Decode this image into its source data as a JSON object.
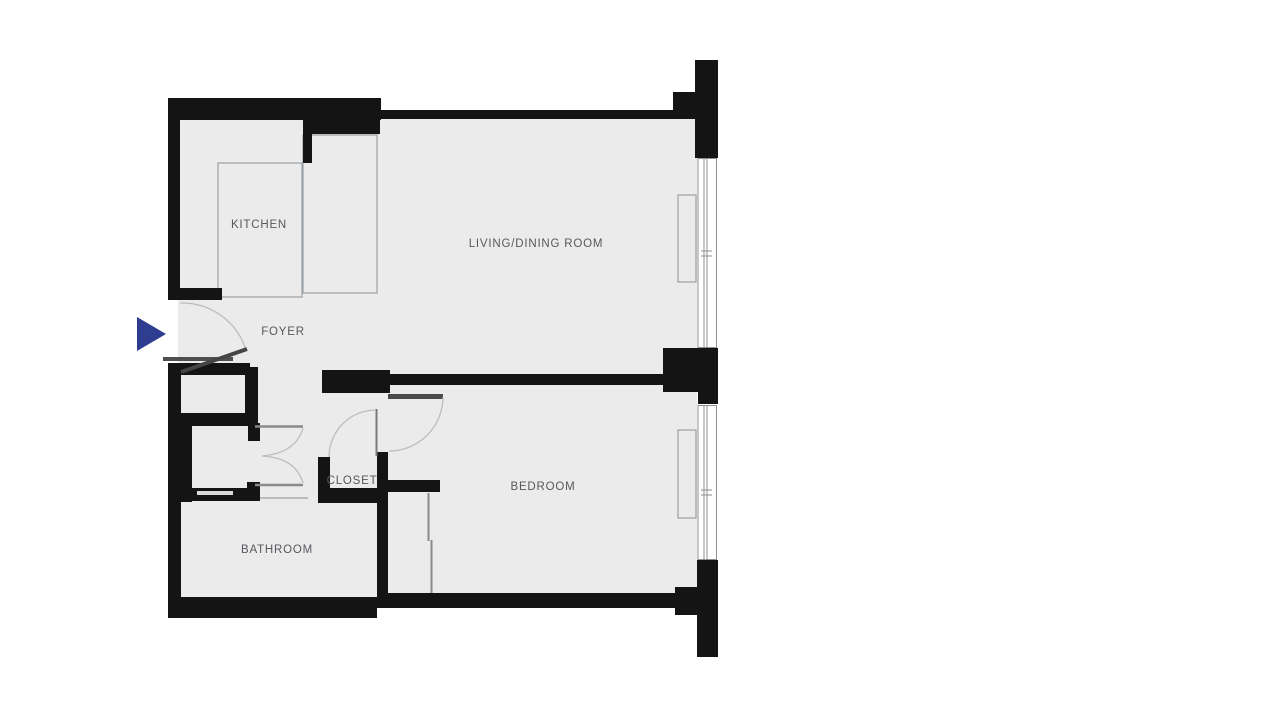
{
  "plan": {
    "title": "One-bedroom apartment floor plan",
    "rooms": [
      {
        "id": "kitchen",
        "label": "KITCHEN"
      },
      {
        "id": "living_dining",
        "label": "LIVING/DINING ROOM"
      },
      {
        "id": "foyer",
        "label": "FOYER"
      },
      {
        "id": "closet",
        "label": "CLOSET"
      },
      {
        "id": "bedroom",
        "label": "BEDROOM"
      },
      {
        "id": "bathroom",
        "label": "BATHROOM"
      }
    ],
    "entry_marker": {
      "type": "arrow",
      "direction": "right"
    },
    "colors": {
      "wall": "#141414",
      "floor": "#ebebec",
      "label": "#58585c",
      "arrow": "#2e3d8f",
      "door_leaf": "#4a4a4a",
      "swing_arc": "#bcbcbc",
      "thin_line": "#9aa0a4"
    }
  }
}
